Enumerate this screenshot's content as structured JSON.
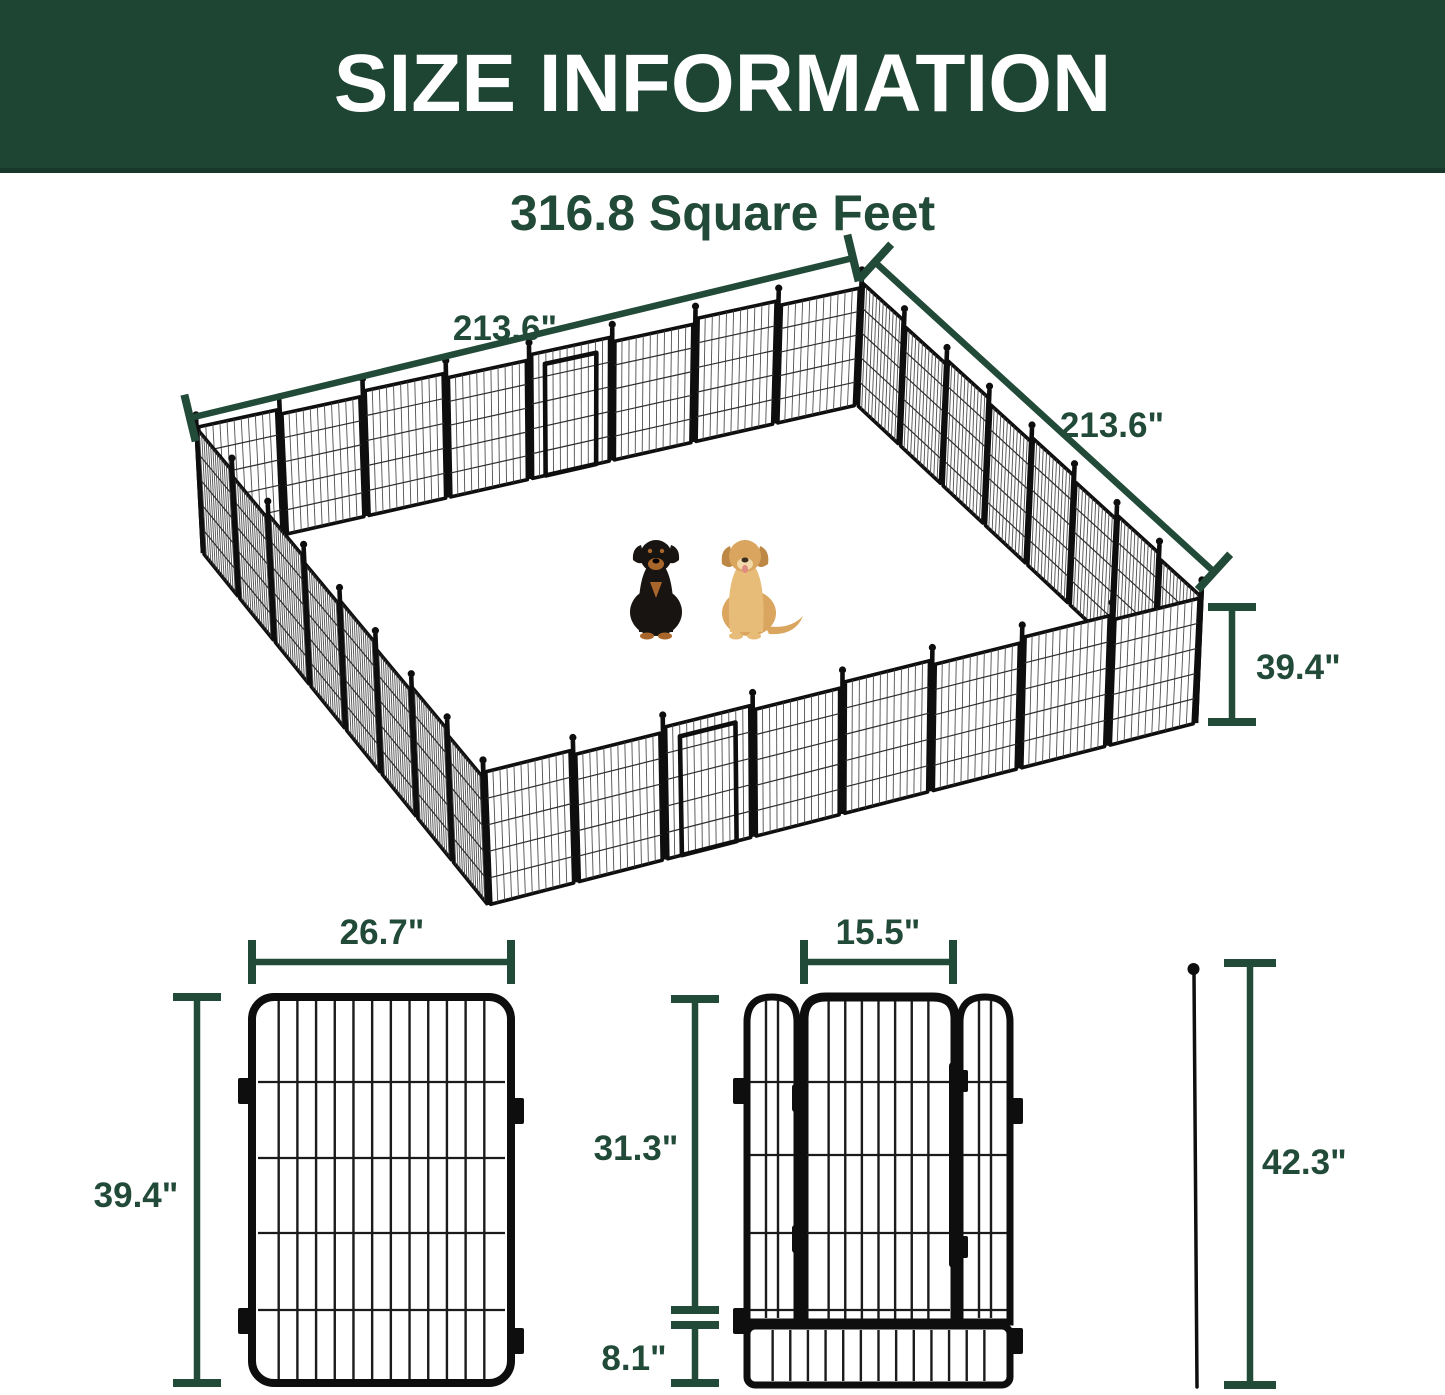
{
  "header": {
    "title": "SIZE INFORMATION"
  },
  "subtitle": "316.8 Square Feet",
  "isometric": {
    "dim_left": "213.6\"",
    "dim_right": "213.6\"",
    "dim_height": "39.4\""
  },
  "panel": {
    "width": "26.7\"",
    "height": "39.4\""
  },
  "gate": {
    "door_width": "15.5\"",
    "door_height": "31.3\"",
    "bottom_height": "8.1\""
  },
  "stake": {
    "height": "42.3\""
  },
  "colors": {
    "header_bg": "#1e4434",
    "accent_green": "#224a39",
    "fence_black": "#0e0e0e",
    "rottweiler_coat": "#181411",
    "rottweiler_tan": "#a9662b",
    "golden_coat": "#d9a55f",
    "golden_light": "#e7bc79"
  }
}
